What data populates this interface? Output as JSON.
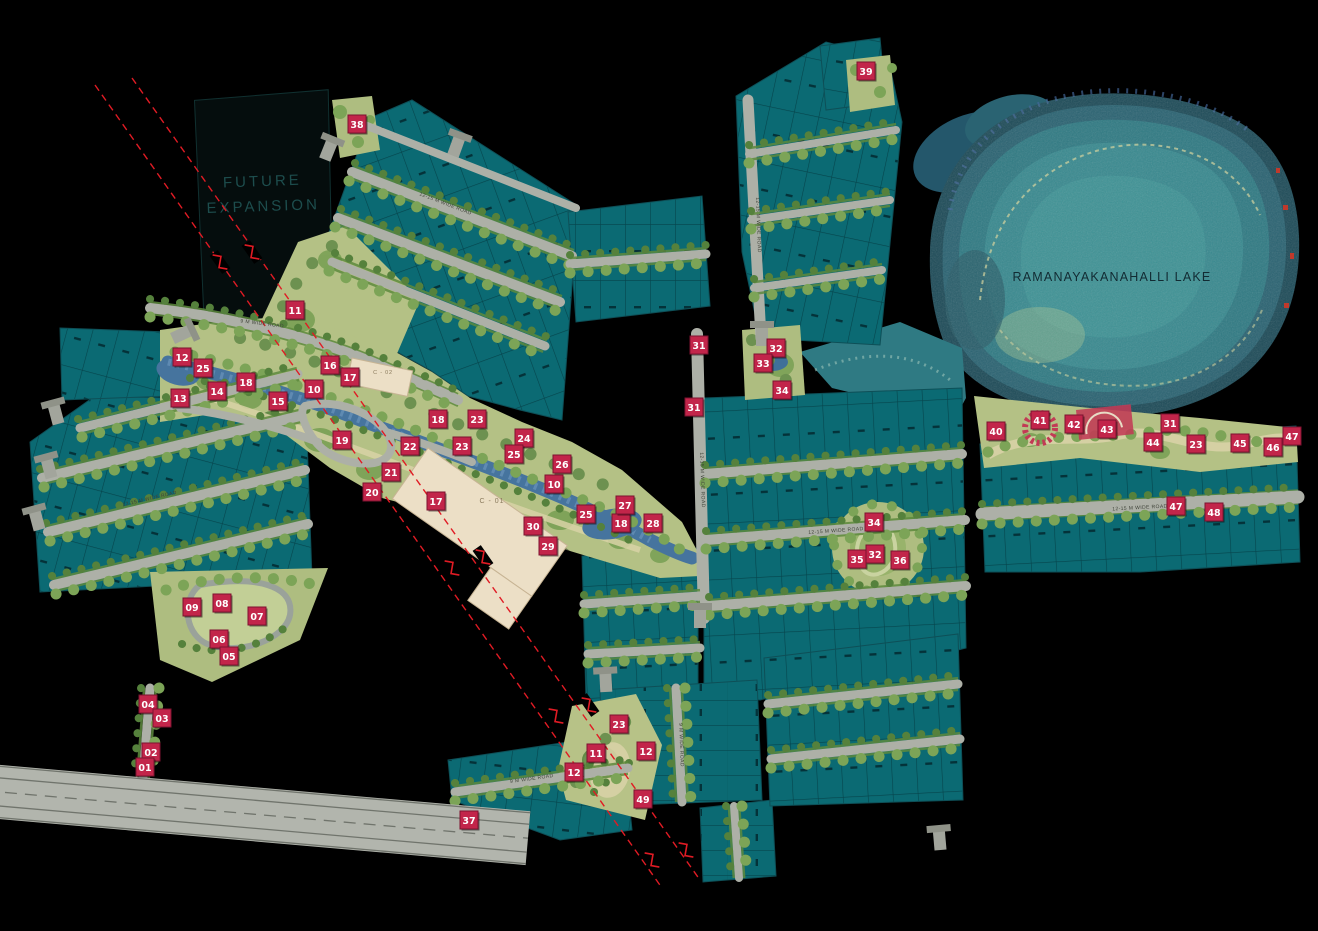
{
  "map": {
    "labels": {
      "future_expansion_line1": "FUTURE",
      "future_expansion_line2": "EXPANSION",
      "lake": "RAMANAYAKANAHALLI LAKE",
      "club_c01": "C - 01",
      "club_c02": "C - 02",
      "road_main": "12-15 M WIDE ROAD",
      "road_minor": "9 M WIDE ROAD"
    },
    "colors": {
      "background": "#000000",
      "plot_fill": "#0b6a73",
      "plot_line": "#06444c",
      "road": "#adb0a7",
      "green_base": "#b4c185",
      "tree": "#7ca457",
      "stream": "#46749e",
      "lake_outer": "#1d4b58",
      "lake_inner": "#38898f",
      "sand_path": "#d8d2a6",
      "building": "#ecdfc6",
      "marker_bg": "#c2254a",
      "marker_border": "#7d1230",
      "marker_text": "#ffffff",
      "section_line": "#e01b24",
      "future_expansion_text": "#1d4d4d"
    },
    "markers": [
      {
        "n": "38",
        "x": 357,
        "y": 124
      },
      {
        "n": "39",
        "x": 866,
        "y": 71
      },
      {
        "n": "11",
        "x": 295,
        "y": 310
      },
      {
        "n": "12",
        "x": 182,
        "y": 357
      },
      {
        "n": "25",
        "x": 203,
        "y": 368
      },
      {
        "n": "13",
        "x": 180,
        "y": 398
      },
      {
        "n": "14",
        "x": 217,
        "y": 391
      },
      {
        "n": "18",
        "x": 246,
        "y": 382
      },
      {
        "n": "15",
        "x": 278,
        "y": 401
      },
      {
        "n": "16",
        "x": 330,
        "y": 365
      },
      {
        "n": "17",
        "x": 350,
        "y": 377
      },
      {
        "n": "10",
        "x": 314,
        "y": 389
      },
      {
        "n": "19",
        "x": 342,
        "y": 440
      },
      {
        "n": "22",
        "x": 410,
        "y": 446
      },
      {
        "n": "21",
        "x": 391,
        "y": 472
      },
      {
        "n": "20",
        "x": 372,
        "y": 492
      },
      {
        "n": "17",
        "x": 436,
        "y": 501
      },
      {
        "n": "18",
        "x": 438,
        "y": 419
      },
      {
        "n": "23",
        "x": 477,
        "y": 419
      },
      {
        "n": "23",
        "x": 462,
        "y": 446
      },
      {
        "n": "24",
        "x": 524,
        "y": 438
      },
      {
        "n": "25",
        "x": 514,
        "y": 454
      },
      {
        "n": "26",
        "x": 562,
        "y": 464
      },
      {
        "n": "10",
        "x": 554,
        "y": 484
      },
      {
        "n": "30",
        "x": 533,
        "y": 526
      },
      {
        "n": "29",
        "x": 548,
        "y": 546
      },
      {
        "n": "25",
        "x": 586,
        "y": 514
      },
      {
        "n": "18",
        "x": 621,
        "y": 523
      },
      {
        "n": "27",
        "x": 625,
        "y": 505
      },
      {
        "n": "28",
        "x": 653,
        "y": 523
      },
      {
        "n": "31",
        "x": 699,
        "y": 345
      },
      {
        "n": "31",
        "x": 694,
        "y": 407
      },
      {
        "n": "32",
        "x": 776,
        "y": 348
      },
      {
        "n": "33",
        "x": 763,
        "y": 363
      },
      {
        "n": "34",
        "x": 782,
        "y": 390
      },
      {
        "n": "34",
        "x": 874,
        "y": 522
      },
      {
        "n": "35",
        "x": 857,
        "y": 559
      },
      {
        "n": "32",
        "x": 875,
        "y": 554
      },
      {
        "n": "36",
        "x": 900,
        "y": 560
      },
      {
        "n": "09",
        "x": 192,
        "y": 607
      },
      {
        "n": "08",
        "x": 222,
        "y": 603
      },
      {
        "n": "07",
        "x": 257,
        "y": 616
      },
      {
        "n": "06",
        "x": 219,
        "y": 639
      },
      {
        "n": "05",
        "x": 229,
        "y": 656
      },
      {
        "n": "04",
        "x": 148,
        "y": 704
      },
      {
        "n": "03",
        "x": 162,
        "y": 718
      },
      {
        "n": "02",
        "x": 151,
        "y": 752
      },
      {
        "n": "01",
        "x": 145,
        "y": 767
      },
      {
        "n": "37",
        "x": 469,
        "y": 820
      },
      {
        "n": "23",
        "x": 619,
        "y": 724
      },
      {
        "n": "11",
        "x": 596,
        "y": 753
      },
      {
        "n": "12",
        "x": 646,
        "y": 751
      },
      {
        "n": "12",
        "x": 574,
        "y": 772
      },
      {
        "n": "49",
        "x": 643,
        "y": 799
      },
      {
        "n": "40",
        "x": 996,
        "y": 431
      },
      {
        "n": "41",
        "x": 1040,
        "y": 420
      },
      {
        "n": "42",
        "x": 1074,
        "y": 424
      },
      {
        "n": "43",
        "x": 1107,
        "y": 429
      },
      {
        "n": "31",
        "x": 1170,
        "y": 423
      },
      {
        "n": "44",
        "x": 1153,
        "y": 442
      },
      {
        "n": "23",
        "x": 1196,
        "y": 444
      },
      {
        "n": "45",
        "x": 1240,
        "y": 443
      },
      {
        "n": "46",
        "x": 1273,
        "y": 447
      },
      {
        "n": "47",
        "x": 1292,
        "y": 436
      },
      {
        "n": "47",
        "x": 1176,
        "y": 506
      },
      {
        "n": "48",
        "x": 1214,
        "y": 512
      }
    ]
  }
}
